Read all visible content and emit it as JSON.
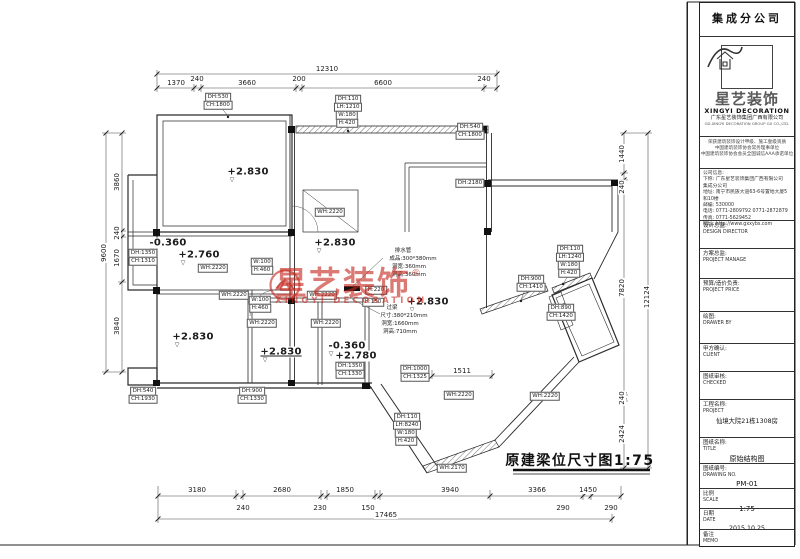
{
  "plan": {
    "title": "原建梁位尺寸图1:75",
    "labels": [
      {
        "x": 327,
        "y": 69,
        "t": "12310",
        "c": "dim"
      },
      {
        "x": 176,
        "y": 83,
        "t": "1370",
        "c": "dim"
      },
      {
        "x": 197,
        "y": 79,
        "t": "240",
        "c": "dim"
      },
      {
        "x": 247,
        "y": 83,
        "t": "3660",
        "c": "dim"
      },
      {
        "x": 299,
        "y": 79,
        "t": "200",
        "c": "dim"
      },
      {
        "x": 383,
        "y": 83,
        "t": "6600",
        "c": "dim"
      },
      {
        "x": 484,
        "y": 79,
        "t": "240",
        "c": "dim"
      },
      {
        "x": 104,
        "y": 253,
        "t": "9600",
        "c": "dim rot"
      },
      {
        "x": 117,
        "y": 182,
        "t": "3860",
        "c": "dim rot"
      },
      {
        "x": 117,
        "y": 233,
        "t": "240",
        "c": "dim rot"
      },
      {
        "x": 117,
        "y": 258,
        "t": "1670",
        "c": "dim rot"
      },
      {
        "x": 117,
        "y": 326,
        "t": "3840",
        "c": "dim rot"
      },
      {
        "x": 622,
        "y": 154,
        "t": "1440",
        "c": "dim rot"
      },
      {
        "x": 622,
        "y": 187,
        "t": "240",
        "c": "dim rot"
      },
      {
        "x": 622,
        "y": 288,
        "t": "7820",
        "c": "dim rot"
      },
      {
        "x": 622,
        "y": 398,
        "t": "240",
        "c": "dim rot"
      },
      {
        "x": 622,
        "y": 434,
        "t": "2424",
        "c": "dim rot"
      },
      {
        "x": 647,
        "y": 297,
        "t": "12124",
        "c": "dim rot"
      },
      {
        "x": 197,
        "y": 490,
        "t": "3180",
        "c": "dim"
      },
      {
        "x": 282,
        "y": 490,
        "t": "2680",
        "c": "dim"
      },
      {
        "x": 345,
        "y": 490,
        "t": "1850",
        "c": "dim"
      },
      {
        "x": 450,
        "y": 490,
        "t": "3940",
        "c": "dim"
      },
      {
        "x": 537,
        "y": 490,
        "t": "3366",
        "c": "dim"
      },
      {
        "x": 588,
        "y": 490,
        "t": "1450",
        "c": "dim"
      },
      {
        "x": 243,
        "y": 508,
        "t": "240",
        "c": "dim"
      },
      {
        "x": 320,
        "y": 508,
        "t": "230",
        "c": "dim"
      },
      {
        "x": 368,
        "y": 508,
        "t": "150",
        "c": "dim"
      },
      {
        "x": 563,
        "y": 508,
        "t": "290",
        "c": "dim"
      },
      {
        "x": 611,
        "y": 508,
        "t": "290",
        "c": "dim"
      },
      {
        "x": 386,
        "y": 515,
        "t": "17465",
        "c": "dim"
      },
      {
        "x": 462,
        "y": 371,
        "t": "1511",
        "c": "dim"
      },
      {
        "x": 248,
        "y": 172,
        "t": "+2.830",
        "c": "elev"
      },
      {
        "x": 335,
        "y": 243,
        "t": "+2.830",
        "c": "elev"
      },
      {
        "x": 428,
        "y": 302,
        "t": "+2.830",
        "c": "elev"
      },
      {
        "x": 193,
        "y": 337,
        "t": "+2.830",
        "c": "elev"
      },
      {
        "x": 281,
        "y": 352,
        "t": "+2.830",
        "c": "elev elev-u"
      },
      {
        "x": 199,
        "y": 255,
        "t": "+2.760",
        "c": "elev"
      },
      {
        "x": 168,
        "y": 243,
        "t": "-0.360",
        "c": "elev"
      },
      {
        "x": 347,
        "y": 346,
        "t": "-0.360",
        "c": "elev"
      },
      {
        "x": 356,
        "y": 356,
        "t": "+2.780",
        "c": "elev"
      },
      {
        "x": 232,
        "y": 180,
        "t": "▽",
        "c": "mark"
      },
      {
        "x": 319,
        "y": 251,
        "t": "▽",
        "c": "mark"
      },
      {
        "x": 412,
        "y": 310,
        "t": "▽",
        "c": "mark"
      },
      {
        "x": 177,
        "y": 345,
        "t": "▽",
        "c": "mark"
      },
      {
        "x": 265,
        "y": 360,
        "t": "▽",
        "c": "mark"
      },
      {
        "x": 183,
        "y": 263,
        "t": "▽",
        "c": "mark"
      },
      {
        "x": 152,
        "y": 251,
        "t": "▽",
        "c": "mark"
      },
      {
        "x": 331,
        "y": 354,
        "t": "▽",
        "c": "mark"
      },
      {
        "x": 340,
        "y": 364,
        "t": "▽",
        "c": "mark"
      },
      {
        "x": 218,
        "y": 97,
        "t": "DH:530",
        "c": "chip"
      },
      {
        "x": 218,
        "y": 105,
        "t": "CH:1800",
        "c": "chip"
      },
      {
        "x": 348,
        "y": 99,
        "t": "DH:110",
        "c": "chip"
      },
      {
        "x": 348,
        "y": 107,
        "t": "LH:1210",
        "c": "chip"
      },
      {
        "x": 347,
        "y": 115,
        "t": "W:180",
        "c": "chip"
      },
      {
        "x": 347,
        "y": 123,
        "t": "H:420",
        "c": "chip"
      },
      {
        "x": 470,
        "y": 127,
        "t": "DH:540",
        "c": "chip"
      },
      {
        "x": 470,
        "y": 135,
        "t": "CH:1800",
        "c": "chip"
      },
      {
        "x": 470,
        "y": 183,
        "t": "DH:2180",
        "c": "chip"
      },
      {
        "x": 330,
        "y": 212,
        "t": "WH:2220",
        "c": "chip"
      },
      {
        "x": 143,
        "y": 253,
        "t": "DH:1350",
        "c": "chip"
      },
      {
        "x": 143,
        "y": 261,
        "t": "CH:1310",
        "c": "chip"
      },
      {
        "x": 213,
        "y": 268,
        "t": "WH:2220",
        "c": "chip"
      },
      {
        "x": 234,
        "y": 295,
        "t": "WH:2220",
        "c": "chip"
      },
      {
        "x": 262,
        "y": 262,
        "t": "W:100",
        "c": "chip"
      },
      {
        "x": 262,
        "y": 270,
        "t": "H:460",
        "c": "chip"
      },
      {
        "x": 260,
        "y": 300,
        "t": "W:100",
        "c": "chip"
      },
      {
        "x": 260,
        "y": 308,
        "t": "H:460",
        "c": "chip"
      },
      {
        "x": 322,
        "y": 295,
        "t": "WH:2220",
        "c": "chip"
      },
      {
        "x": 376,
        "y": 290,
        "t": "H:220",
        "c": "chip"
      },
      {
        "x": 373,
        "y": 302,
        "t": "H:150",
        "c": "chip"
      },
      {
        "x": 262,
        "y": 323,
        "t": "WH:2220",
        "c": "chip"
      },
      {
        "x": 326,
        "y": 323,
        "t": "WH:2220",
        "c": "chip"
      },
      {
        "x": 350,
        "y": 366,
        "t": "DH:1350",
        "c": "chip"
      },
      {
        "x": 350,
        "y": 374,
        "t": "CH:1330",
        "c": "chip"
      },
      {
        "x": 415,
        "y": 369,
        "t": "DH:1000",
        "c": "chip"
      },
      {
        "x": 415,
        "y": 377,
        "t": "CH:1325",
        "c": "chip"
      },
      {
        "x": 459,
        "y": 395,
        "t": "WH:2220",
        "c": "chip"
      },
      {
        "x": 545,
        "y": 396,
        "t": "WH:2220",
        "c": "chip"
      },
      {
        "x": 407,
        "y": 417,
        "t": "DH:110",
        "c": "chip"
      },
      {
        "x": 407,
        "y": 425,
        "t": "LH:8240",
        "c": "chip"
      },
      {
        "x": 406,
        "y": 433,
        "t": "W:180",
        "c": "chip"
      },
      {
        "x": 406,
        "y": 441,
        "t": "H:420",
        "c": "chip"
      },
      {
        "x": 452,
        "y": 468,
        "t": "WH:2170",
        "c": "chip"
      },
      {
        "x": 531,
        "y": 279,
        "t": "DH:900",
        "c": "chip"
      },
      {
        "x": 531,
        "y": 287,
        "t": "CH:1410",
        "c": "chip"
      },
      {
        "x": 561,
        "y": 308,
        "t": "DH:890",
        "c": "chip"
      },
      {
        "x": 561,
        "y": 316,
        "t": "CH:1420",
        "c": "chip"
      },
      {
        "x": 570,
        "y": 249,
        "t": "DH:110",
        "c": "chip"
      },
      {
        "x": 570,
        "y": 257,
        "t": "LH:1240",
        "c": "chip"
      },
      {
        "x": 569,
        "y": 265,
        "t": "W:180",
        "c": "chip"
      },
      {
        "x": 569,
        "y": 273,
        "t": "H:420",
        "c": "chip"
      },
      {
        "x": 143,
        "y": 391,
        "t": "DH:540",
        "c": "chip"
      },
      {
        "x": 143,
        "y": 399,
        "t": "CH:1930",
        "c": "chip"
      },
      {
        "x": 252,
        "y": 391,
        "t": "DH:900",
        "c": "chip"
      },
      {
        "x": 252,
        "y": 399,
        "t": "CH:1330",
        "c": "chip"
      },
      {
        "x": 403,
        "y": 250,
        "t": "排水管",
        "c": "note"
      },
      {
        "x": 413,
        "y": 258,
        "t": "成品:300*380mm",
        "c": "note"
      },
      {
        "x": 409,
        "y": 266,
        "t": "洞宽:360mm",
        "c": "note"
      },
      {
        "x": 409,
        "y": 274,
        "t": "洞高:360mm",
        "c": "note"
      },
      {
        "x": 392,
        "y": 307,
        "t": "过梁",
        "c": "note"
      },
      {
        "x": 404,
        "y": 315,
        "t": "尺寸:380*210mm",
        "c": "note"
      },
      {
        "x": 400,
        "y": 323,
        "t": "洞宽:1660mm",
        "c": "note"
      },
      {
        "x": 400,
        "y": 331,
        "t": "洞高:710mm",
        "c": "note"
      },
      {
        "x": 580,
        "y": 460,
        "t": "原建梁位尺寸图1:75",
        "c": "ptitle"
      }
    ]
  },
  "watermark": {
    "brand": "星艺装饰",
    "reg": "®",
    "sub": "XINGYI DECORATION"
  },
  "title_block": {
    "branch": "集成分公司",
    "logo": {
      "brand_cn": "星艺装饰",
      "brand_en": "XINGYI DECORATION",
      "company": "广东星艺装饰集团广西有限公司",
      "company_en": "GD.XINGYI DECORATION GROUP GX CO.,LTD."
    },
    "credentials": [
      "荣获建筑装饰设计甲级、施工壹级资质",
      "中国建筑装饰协会常务理事单位",
      "中国建筑装饰协会会员全国诚信AAA承诺单位"
    ],
    "company_info": [
      "公司信息:",
      "下称: 广东星艺装饰集团广西有限公司",
      "集成分公司",
      "地址: 南宁市民族大道63-6号置地大厦5和10楼",
      "邮编: 530000",
      "电话: 0771-2809792 0771-2872879",
      "传真: 0771-5629452",
      "网址: http://www.gxxybs.com"
    ],
    "fields": [
      {
        "cn": "设计总监:",
        "en": "DESIGN DIRECTOR",
        "value": ""
      },
      {
        "cn": "方案总监:",
        "en": "PROJECT MANAGE",
        "value": ""
      },
      {
        "cn": "预算/造价负责:",
        "en": "PROJECT PRICE",
        "value": ""
      },
      {
        "cn": "绘图:",
        "en": "DRAWER BY",
        "value": ""
      },
      {
        "cn": "甲方确认:",
        "en": "CLIENT",
        "value": ""
      },
      {
        "cn": "图纸审核:",
        "en": "CHECKED",
        "value": ""
      },
      {
        "cn": "工程名称:",
        "en": "PROJECT",
        "value": "仙境大院21栋1308房"
      },
      {
        "cn": "图纸名称:",
        "en": "TITLE",
        "value": "原始结构图"
      },
      {
        "cn": "图纸编号:",
        "en": "DRAWING NO.",
        "value": "PM-01"
      },
      {
        "cn": "比例",
        "en": "SCALE",
        "value": "1:75"
      },
      {
        "cn": "日期",
        "en": "DATE",
        "value": "2015.10.25"
      },
      {
        "cn": "备注",
        "en": "MEMO",
        "value": ""
      }
    ]
  }
}
